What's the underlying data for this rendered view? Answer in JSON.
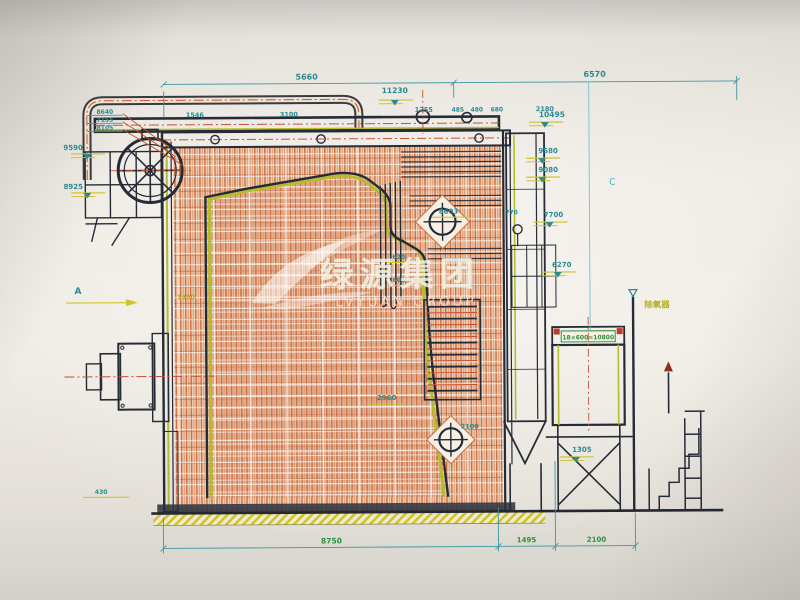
{
  "colors": {
    "paper": "#eceae3",
    "line_dark": "#262b36",
    "hatch_orange": "#cf6b3c",
    "accent_yellow_green": "#b5bd2e",
    "dim_teal": "#2c8a91",
    "centerline_red": "#c8502f",
    "frame_cyan": "#3fb0c6",
    "note_green": "#2f8f3f",
    "ground_yellow": "#cfc21f",
    "watermark_white": "rgba(240,248,238,0.82)"
  },
  "icons": {
    "level_symbol": "▽",
    "target_symbol": "⊕",
    "flag_symbol": "▲"
  },
  "watermark": {
    "cn": "绿源集团",
    "en": "LVYUAN GROUP"
  },
  "markers": {
    "section_a": "A",
    "section_c": "C",
    "deaerator": "除氧器"
  },
  "dims": {
    "top_left": "5660",
    "top_right": "6570",
    "elev_11230": "11230",
    "rail": [
      "1546",
      "3100",
      "1255",
      "485",
      "480",
      "680",
      "2180"
    ],
    "left_stack": [
      "8640",
      "7155",
      "8105"
    ],
    "elev_9590": "9590",
    "elev_8925": "8925",
    "elev_10495": "10495",
    "elev_9580": "9580",
    "elev_9080": "9080",
    "elev_7700": "7700",
    "elev_6270": "6270",
    "elev_1305": "1305",
    "label_8603": "8603",
    "label_770": "770",
    "label_620": "620",
    "label_600": "600",
    "label_1480": "1480",
    "label_2960": "2960",
    "label_2100_mid": "2100",
    "label_430": "430",
    "bottom": [
      "8750",
      "1495",
      "2100"
    ],
    "tube_note": "18×600=10800"
  }
}
